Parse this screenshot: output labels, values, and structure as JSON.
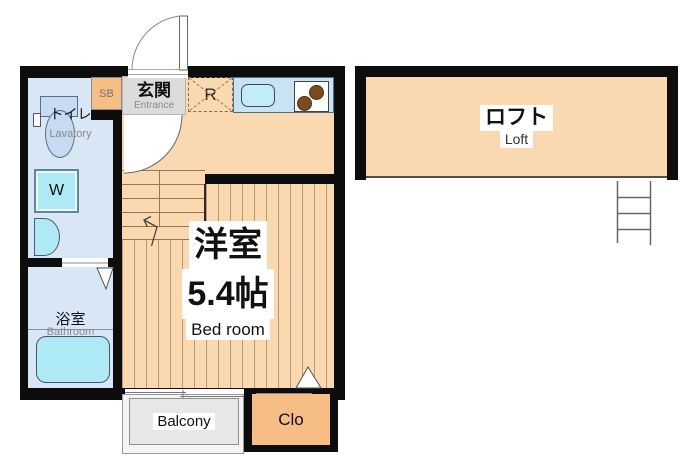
{
  "title": "Apartment floor plan",
  "rooms": {
    "entrance": {
      "jp": "玄関",
      "en": "Entrance"
    },
    "shoe_box": {
      "abbr": "SB"
    },
    "refrigerator": {
      "abbr": "R"
    },
    "lavatory": {
      "jp": "トイレ",
      "en": "Lavatory"
    },
    "washer": {
      "abbr": "W"
    },
    "bathroom": {
      "jp": "浴室",
      "en": "Bathroom"
    },
    "bedroom": {
      "jp": "洋室",
      "size": "5.4帖",
      "en": "Bed room"
    },
    "closet": {
      "abbr": "Clo"
    },
    "balcony": {
      "en": "Balcony"
    },
    "loft": {
      "jp": "ロフト",
      "en": "Loft"
    }
  },
  "colors": {
    "wall": "#0d0d0d",
    "floor": "#fad8b0",
    "floor-line": "#9b7450",
    "wet-room": "#d8e6f6",
    "fixture": "#aeeaf5",
    "toilet": "#c6daf2",
    "counter": "#c9e2f4",
    "storage": "#f6bd85",
    "entrance-gray": "#dcdcdc",
    "balcony-gray": "#e7e7e7",
    "stove-burner": "#7b4b20",
    "muted-text": "#8a8a8a"
  }
}
